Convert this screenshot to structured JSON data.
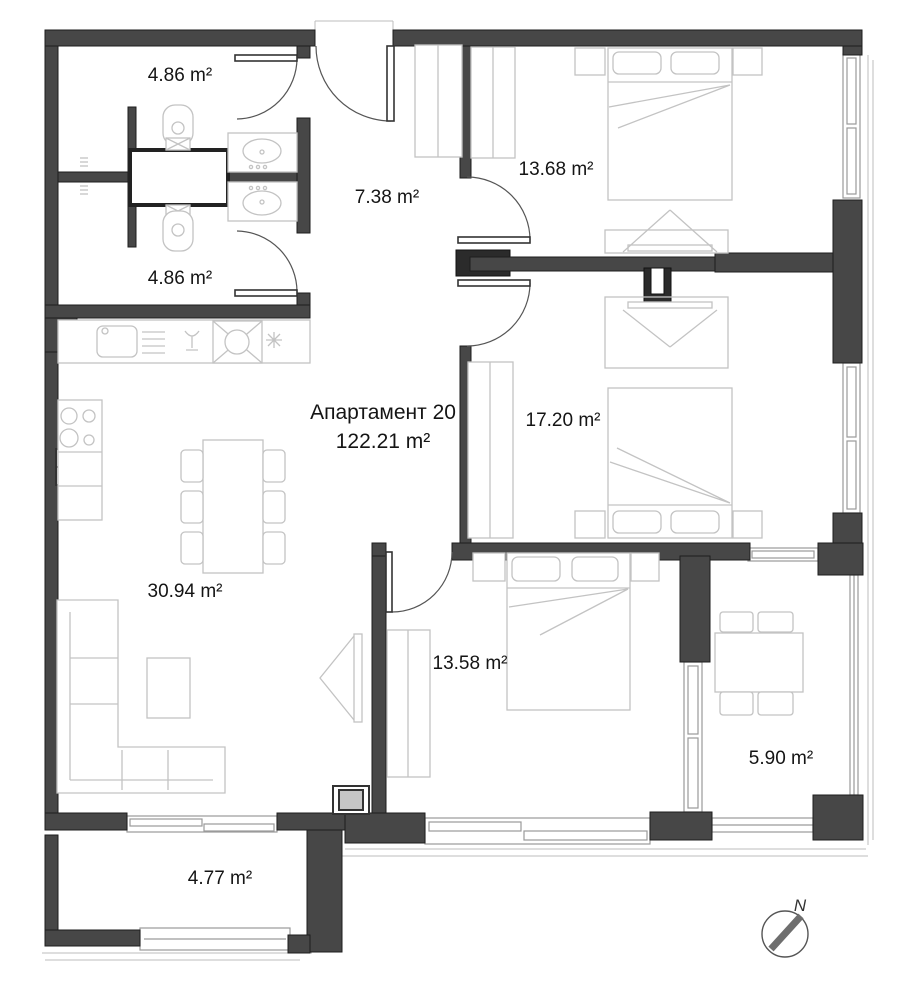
{
  "plan": {
    "title": "Апартамент 20",
    "total_area": "122.21 m²",
    "compass_label": "N",
    "rooms": [
      {
        "id": "bathroom-top",
        "area": "4.86 m²"
      },
      {
        "id": "bathroom-bottom",
        "area": "4.86 m²"
      },
      {
        "id": "entrance-hall",
        "area": "7.38 m²"
      },
      {
        "id": "bedroom-top-right",
        "area": "13.68 m²"
      },
      {
        "id": "bedroom-mid-right",
        "area": "17.20 m²"
      },
      {
        "id": "living-room",
        "area": "30.94 m²"
      },
      {
        "id": "bedroom-bottom",
        "area": "13.58 m²"
      },
      {
        "id": "terrace-right",
        "area": "5.90 m²"
      },
      {
        "id": "balcony-left",
        "area": "4.77 m²"
      }
    ],
    "colors": {
      "wall": "#474747",
      "wall_dark": "#2b2b2b",
      "furniture_outline": "#c3c3c3",
      "window_frame": "#9a9a9a",
      "text": "#141414"
    }
  }
}
